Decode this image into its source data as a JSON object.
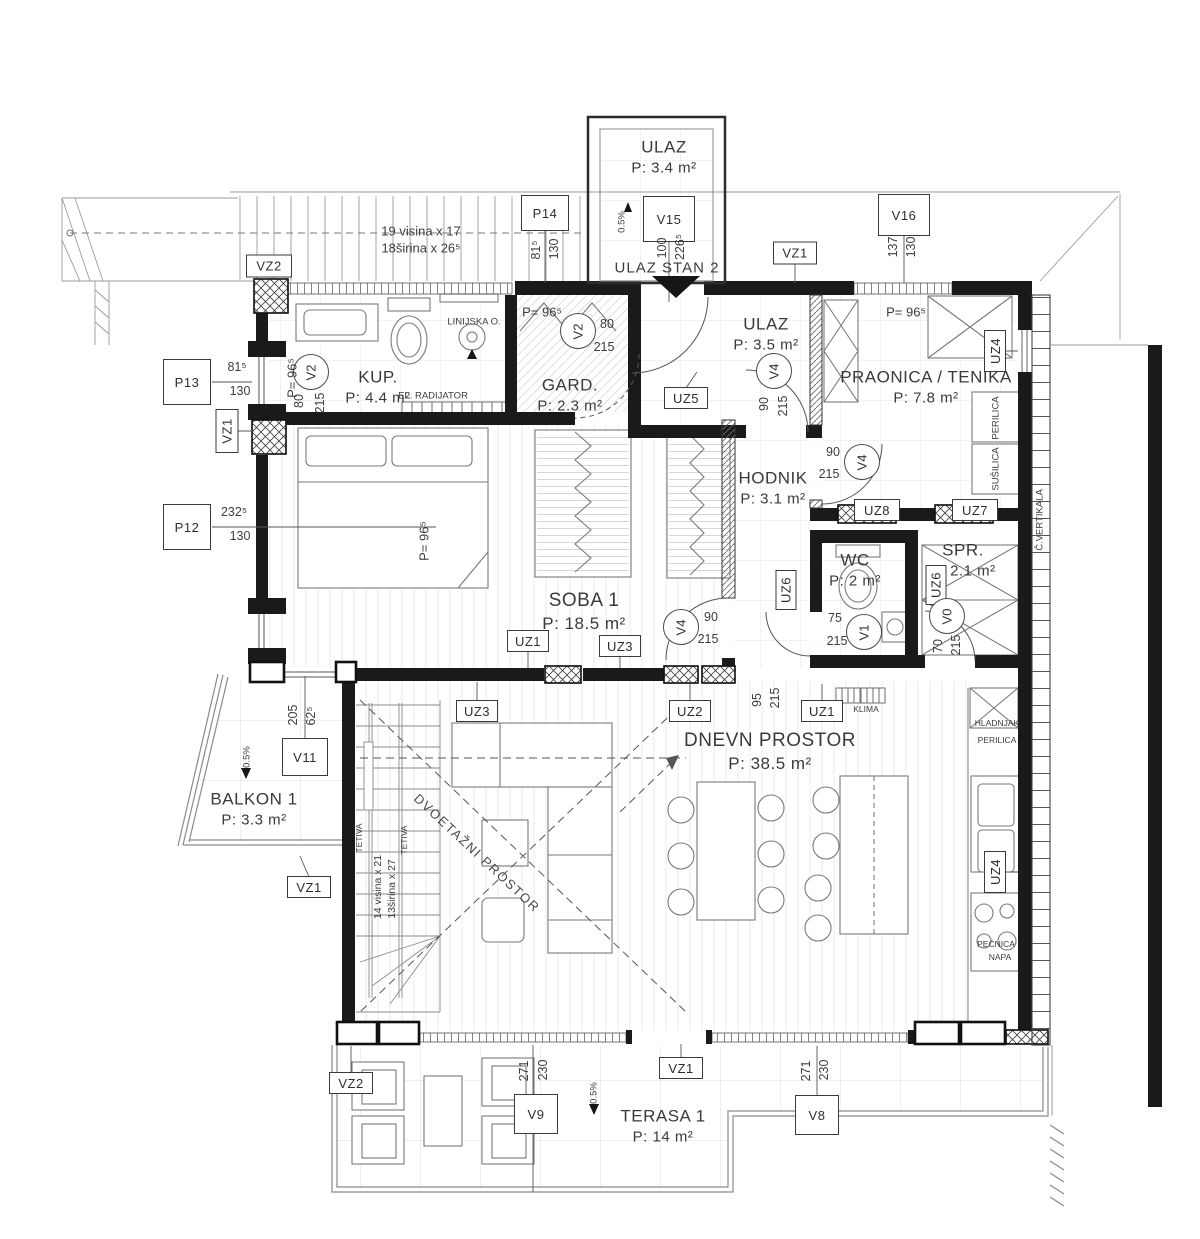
{
  "rooms": {
    "ulaz_top": {
      "name": "ULAZ",
      "area": "P: 3.4 m²"
    },
    "kup": {
      "name": "KUP.",
      "area": "P: 4.4 m²"
    },
    "gard": {
      "name": "GARD.",
      "area": "P: 2.3 m²"
    },
    "ulaz_mid": {
      "name": "ULAZ",
      "area": "P: 3.5 m²"
    },
    "praonica": {
      "name": "PRAONICA / TENIKA",
      "area": "P: 7.8 m²"
    },
    "hodnik": {
      "name": "HODNIK",
      "area": "P: 3.1 m²"
    },
    "wc": {
      "name": "WC",
      "area": "P: 2 m²"
    },
    "spr": {
      "name": "SPR.",
      "area": "P: 2.1 m²"
    },
    "soba1": {
      "name": "SOBA 1",
      "area": "P: 18.5 m²"
    },
    "dnevni": {
      "name": "DNEVN PROSTOR",
      "area": "P: 38.5 m²"
    },
    "balkon": {
      "name": "BALKON 1",
      "area": "P: 3.3 m²"
    },
    "terasa": {
      "name": "TERASA 1",
      "area": "P: 14 m²"
    }
  },
  "tags": {
    "p14": "P14",
    "p13": "P13",
    "p12": "P12",
    "v15": "V15",
    "v16": "V16",
    "v11": "V11",
    "v9": "V9",
    "v8": "V8",
    "vz1": "VZ1",
    "vz2": "VZ2",
    "uz1": "UZ1",
    "uz2": "UZ2",
    "uz3": "UZ3",
    "uz4": "UZ4",
    "uz5": "UZ5",
    "uz6": "UZ6",
    "uz7": "UZ7",
    "uz8": "UZ8"
  },
  "doors": {
    "v0": "V0",
    "v1": "V1",
    "v2": "V2",
    "v4": "V4"
  },
  "dims": {
    "p14": [
      "81⁵",
      "130"
    ],
    "v15": [
      "100",
      "226⁵"
    ],
    "v16": [
      "137",
      "130"
    ],
    "p13": [
      "81⁵",
      "130"
    ],
    "p12": [
      "232⁵",
      "130"
    ],
    "v11": [
      "62⁵",
      "205"
    ],
    "v9": [
      "271",
      "230"
    ],
    "v8": [
      "271",
      "230"
    ],
    "v2": [
      "80",
      "215"
    ],
    "v4": [
      "90",
      "215"
    ],
    "v1": [
      "75",
      "215"
    ],
    "v0": [
      "70",
      "215"
    ],
    "opening": [
      "95",
      "215"
    ],
    "parapet": "P= 96⁵"
  },
  "ann": {
    "entrance": "ULAZ STAN 2",
    "stairs_top_1": "19 visina x 17",
    "stairs_top_2": "18širina x 26⁵",
    "stairs_main_1": "14 visina x 21",
    "stairs_main_2": "13širina x 27",
    "tetiva": "TETIVA",
    "dvoetazni": "DVOETAŽNI PROSTOR",
    "linijska": "LINIJSKA O.",
    "radijator": "EL. RADIJATOR",
    "perilica": "PERILICA",
    "susilica": "SUŠILICA",
    "vertikala": "Č.VERTIKALA",
    "klima": "KLIMA",
    "hladnjak": "HLADNJAK",
    "perilica_k": "PERILICA",
    "pecnica": "PEĆNICA",
    "napa": "NAPA",
    "slope": "0.5%"
  },
  "colors": {
    "wall": "#1a1a1a",
    "line": "#555555",
    "light": "#9a9a9a"
  }
}
